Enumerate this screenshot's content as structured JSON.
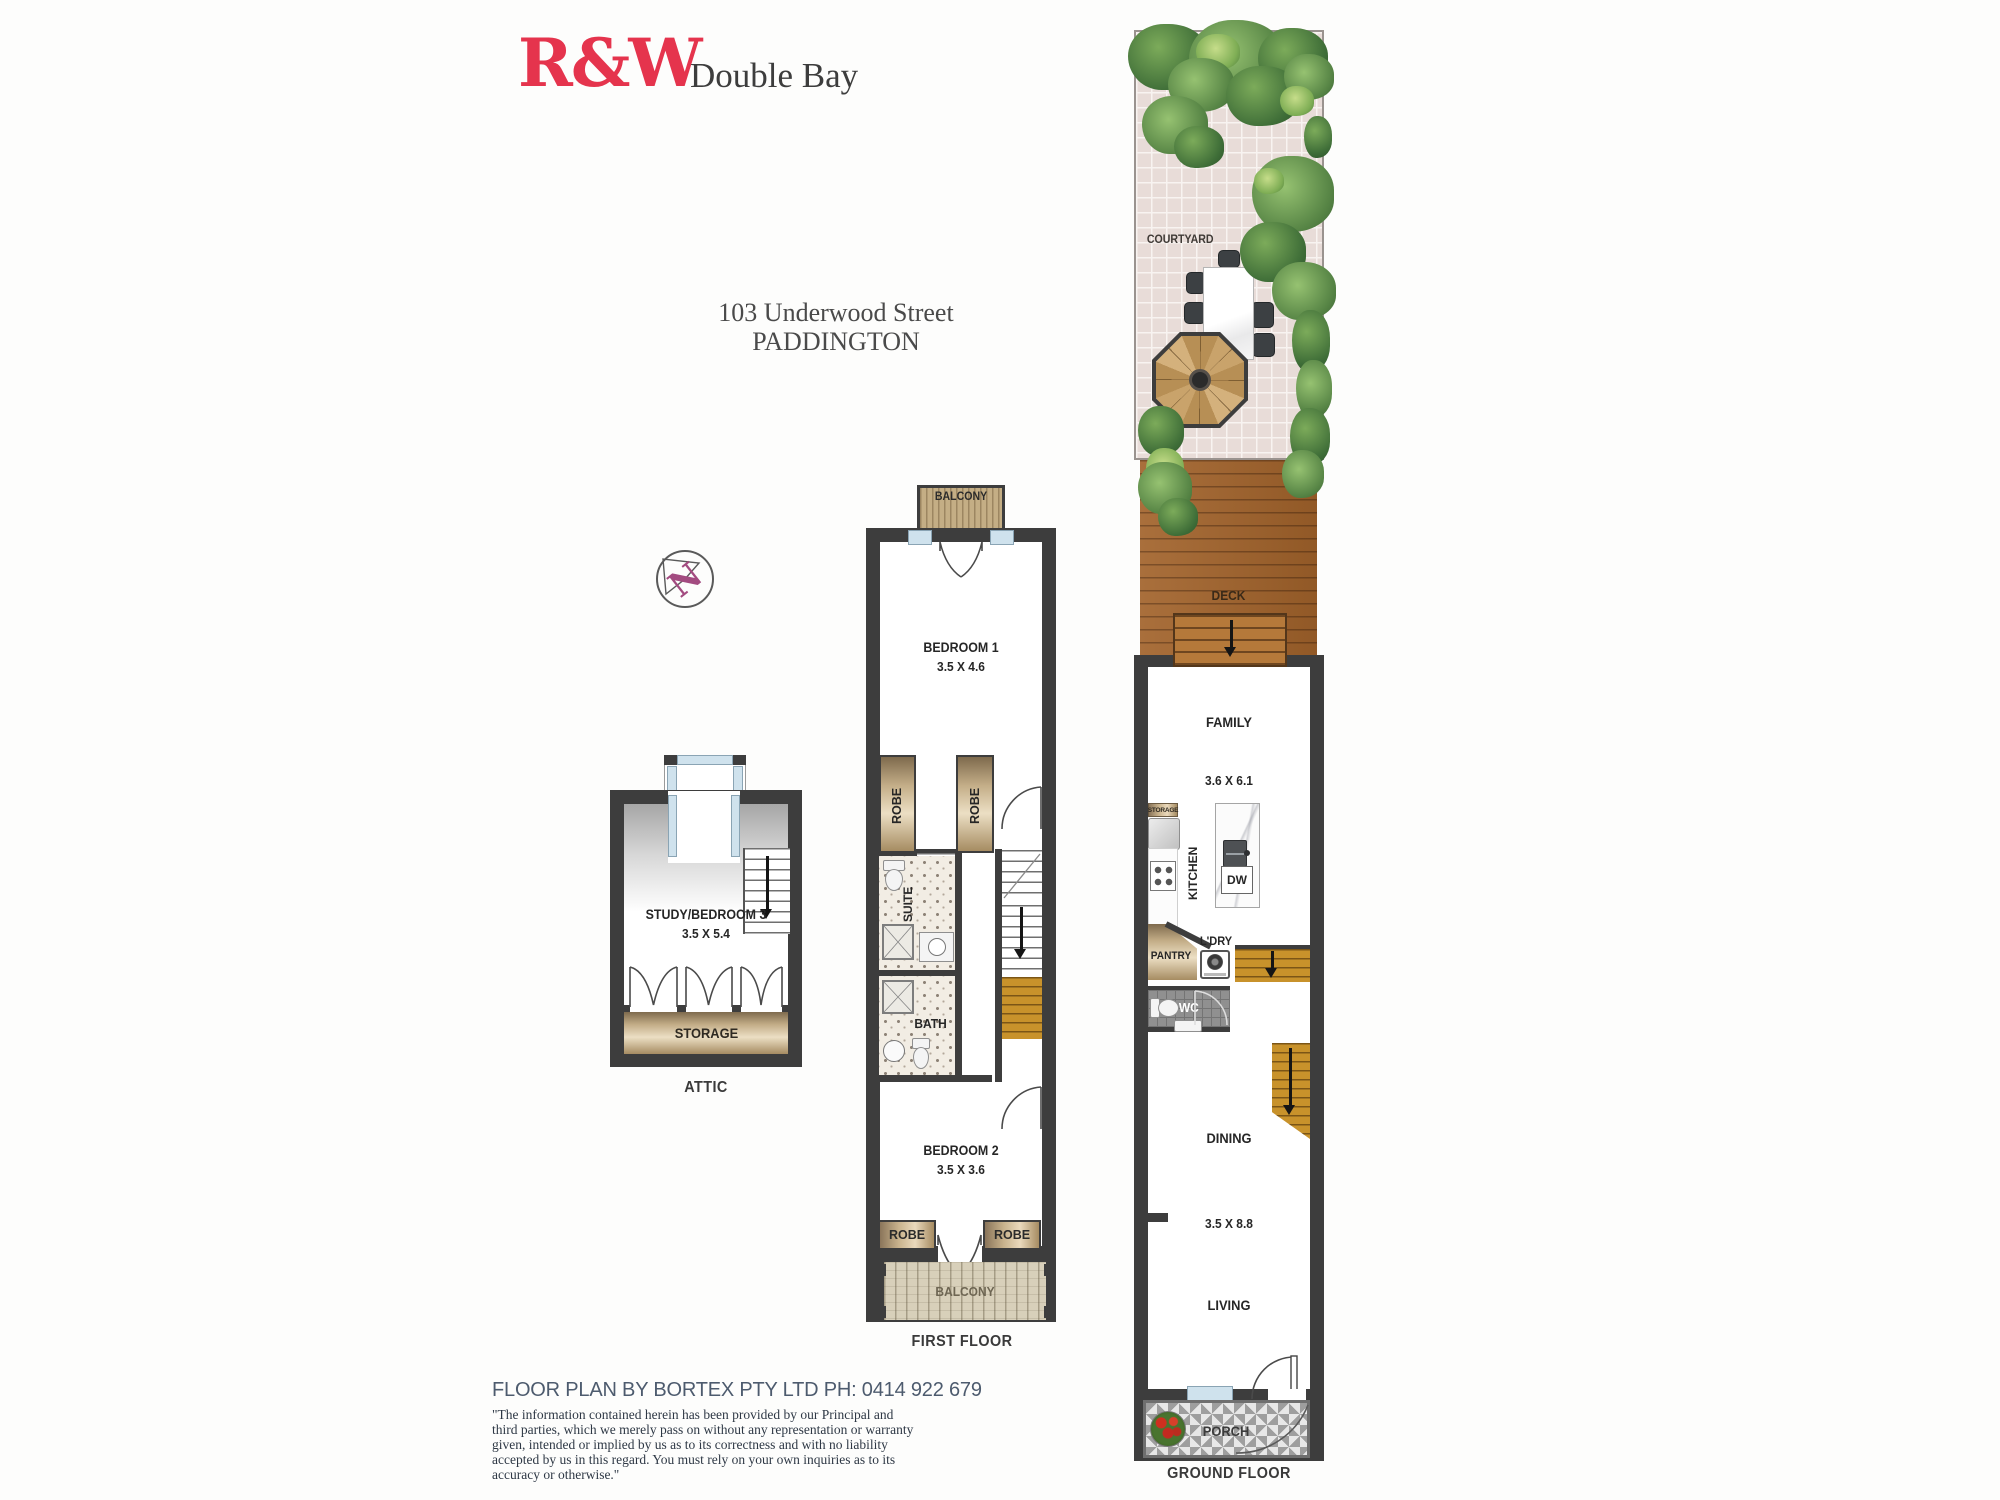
{
  "brand": {
    "logo": "R&W",
    "office": "Double Bay"
  },
  "address": {
    "line1": "103 Underwood Street",
    "line2": "PADDINGTON"
  },
  "compass": {
    "north": "N"
  },
  "attic": {
    "floor_label": "ATTIC",
    "room_name": "STUDY/BEDROOM 3",
    "room_dims": "3.5 X 5.4",
    "storage_label": "STORAGE"
  },
  "first_floor": {
    "floor_label": "FIRST FLOOR",
    "balcony_top": "BALCONY",
    "bedroom1_name": "BEDROOM 1",
    "bedroom1_dims": "3.5 X 4.6",
    "robe_left": "ROBE",
    "robe_right": "ROBE",
    "ensuite": "EN SUITE",
    "bath": "BATH",
    "bedroom2_name": "BEDROOM 2",
    "bedroom2_dims": "3.5 X 3.6",
    "robe2_left": "ROBE",
    "robe2_right": "ROBE",
    "balcony_bottom": "BALCONY"
  },
  "ground_floor": {
    "floor_label": "GROUND FLOOR",
    "courtyard": "COURTYARD",
    "deck": "DECK",
    "family_name": "FAMILY",
    "family_dims": "3.6 X 6.1",
    "storage": "STORAGE",
    "kitchen": "KITCHEN",
    "dw": "DW",
    "pantry": "PANTRY",
    "laundry": "L'DRY",
    "wc": "WC",
    "dining": "DINING",
    "living_dims": "3.5 X 8.8",
    "living": "LIVING",
    "porch": "PORCH"
  },
  "footer": {
    "credit": "FLOOR PLAN BY BORTEX PTY LTD PH: 0414 922 679",
    "disclaimer": "\"The information contained herein has been provided by our Principal and third parties, which we merely pass on without any representation or warranty given, intended or implied by us as to its correctness and with no liability accepted by us in this regard. You must rely on your own inquiries as to its accuracy or otherwise.\""
  },
  "colors": {
    "brand_red": "#e5344d",
    "wall": "#3d3d3d",
    "deck_wood": "#a2632b",
    "stair_wood": "#c8922b",
    "compass_n": "#a34b80",
    "credit_text": "#4d5b6e"
  }
}
